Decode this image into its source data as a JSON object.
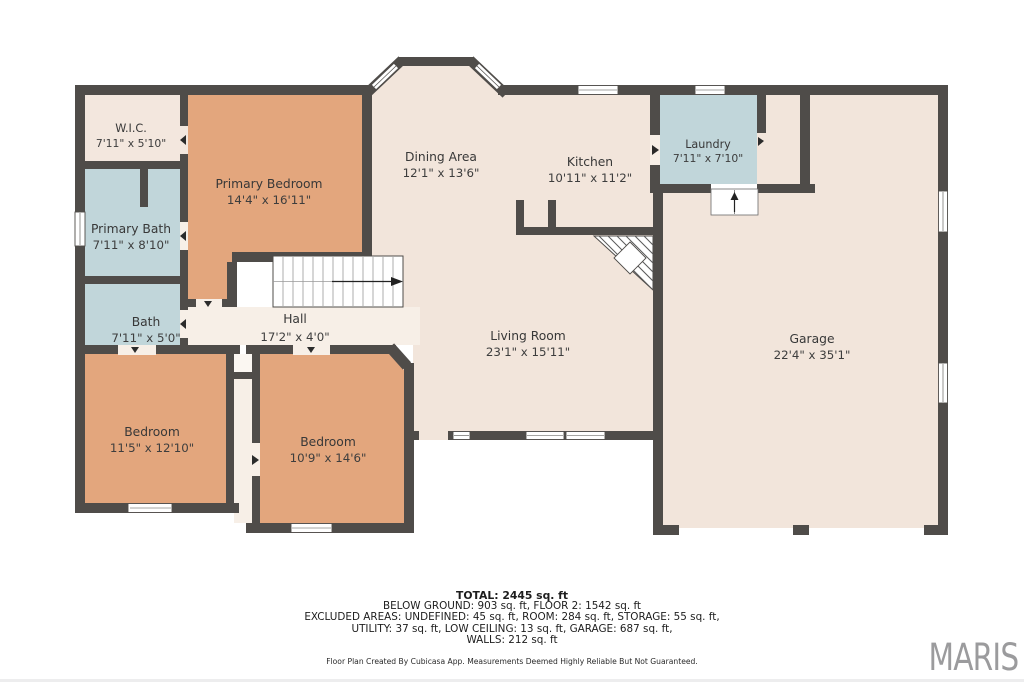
{
  "palette": {
    "wall": "#4f4c49",
    "cream": "#f2e5db",
    "cream_light": "#f7efe7",
    "wic_cream": "#f3e7de",
    "bedroom_orange": "#e3a67d",
    "wet_blue": "#c1d6da",
    "logo_gray": "#9b9b9d"
  },
  "rooms": {
    "wic": {
      "name": "W.I.C.",
      "dims": "7'11\" x 5'10\""
    },
    "primary_bath": {
      "name": "Primary Bath",
      "dims": "7'11\" x 8'10\""
    },
    "bath": {
      "name": "Bath",
      "dims": "7'11\" x 5'0\""
    },
    "primary_bedroom": {
      "name": "Primary Bedroom",
      "dims": "14'4\" x 16'11\""
    },
    "hall": {
      "name": "Hall",
      "dims": "17'2\" x 4'0\""
    },
    "bedroom_left": {
      "name": "Bedroom",
      "dims": "11'5\" x 12'10\""
    },
    "bedroom_right": {
      "name": "Bedroom",
      "dims": "10'9\" x 14'6\""
    },
    "dining": {
      "name": "Dining Area",
      "dims": "12'1\" x 13'6\""
    },
    "kitchen": {
      "name": "Kitchen",
      "dims": "10'11\" x 11'2\""
    },
    "living": {
      "name": "Living Room",
      "dims": "23'1\" x 15'11\""
    },
    "laundry": {
      "name": "Laundry",
      "dims": "7'11\" x 7'10\""
    },
    "garage": {
      "name": "Garage",
      "dims": "22'4\" x 35'1\""
    }
  },
  "summary": {
    "total": "TOTAL: 2445 sq. ft",
    "line2": "BELOW GROUND: 903 sq. ft, FLOOR 2: 1542 sq. ft",
    "line3": "EXCLUDED AREAS: UNDEFINED: 45 sq. ft, ROOM: 284 sq. ft, STORAGE: 55 sq. ft,",
    "line4": "UTILITY: 37 sq. ft, LOW CEILING: 13 sq. ft, GARAGE: 687 sq. ft,",
    "line5": "WALLS: 212 sq. ft"
  },
  "footer": {
    "disclaimer": "Floor Plan Created By Cubicasa App. Measurements Deemed Highly Reliable But Not Guaranteed.",
    "logo": "MARIS"
  }
}
